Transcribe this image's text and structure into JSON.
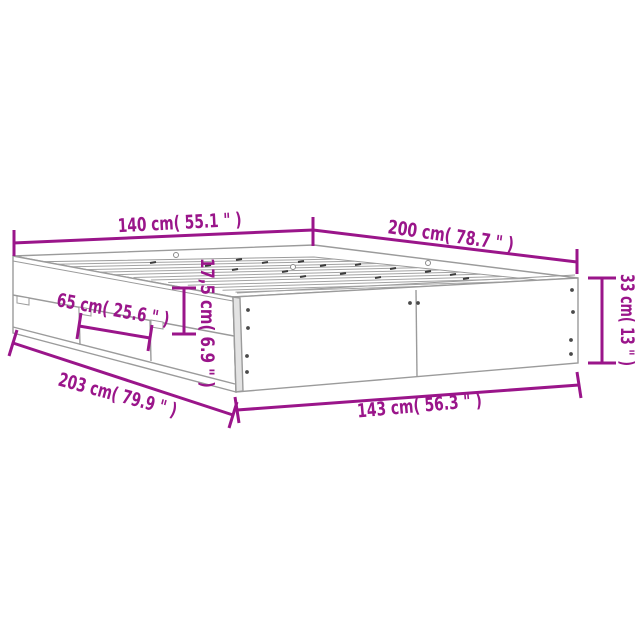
{
  "colors": {
    "dimension_accent": "#9A158A",
    "drawing_outline": "#9B9B9B",
    "background": "#FFFFFF"
  },
  "diagram_type": "bed-frame-with-drawers-dimension-diagram",
  "dimensions": {
    "top_width": {
      "label": "140 cm( 55.1 \" )",
      "cm": "140",
      "inches": "55.1"
    },
    "top_length": {
      "label": "200 cm( 78.7 \" )",
      "cm": "200",
      "inches": "78.7"
    },
    "side_height": {
      "label": "33 cm( 13 \" )",
      "cm": "33",
      "inches": "13"
    },
    "drawer_width": {
      "label": "65 cm( 25.6 \" )",
      "cm": "65",
      "inches": "25.6"
    },
    "rail_height": {
      "label": "17,5 cm( 6.9 \" )",
      "cm": "17,5",
      "inches": "6.9"
    },
    "base_length": {
      "label": "203 cm( 79.9 \" )",
      "cm": "203",
      "inches": "79.9"
    },
    "base_width": {
      "label": "143 cm( 56.3 \" )",
      "cm": "143",
      "inches": "56.3"
    }
  }
}
